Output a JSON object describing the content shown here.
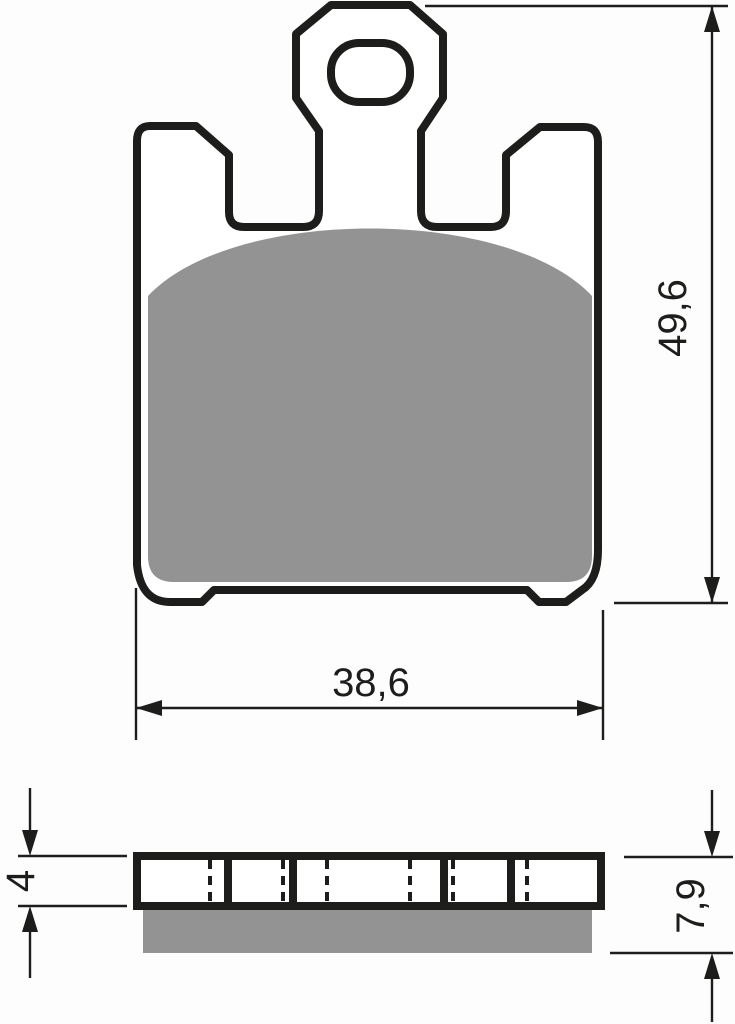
{
  "drawing": {
    "title": "Brake pad technical drawing",
    "views": {
      "front_view": "brake pad front view with mounting tab and friction material",
      "side_view": "brake pad side section view with backplate and friction layer"
    },
    "dimensions": {
      "overall_height": "49,6",
      "overall_width": "38,6",
      "backplate_thickness": "4",
      "total_thickness": "7,9"
    },
    "icons": {
      "arrowheads": "dimension-arrow-icon"
    },
    "colors": {
      "line": "#1d1d1b",
      "friction_material": "#939393",
      "backplate_fill": "#ffffff",
      "background": "#fdfdfd"
    }
  }
}
